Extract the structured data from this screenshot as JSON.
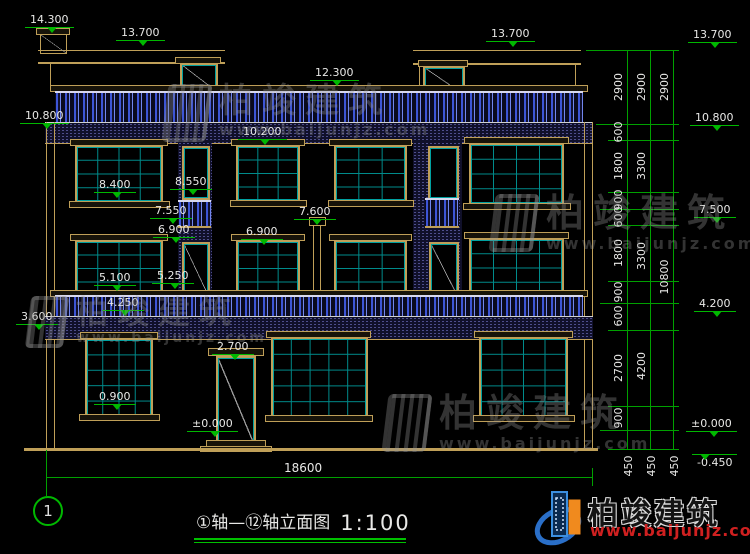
{
  "watermark": {
    "cn": "柏竣建筑",
    "url": "www.baijunjz.com"
  },
  "brand": {
    "cn": "柏竣建筑",
    "url": "www.baijunjz.com"
  },
  "title": {
    "text": "①轴—⑫轴立面图",
    "scale": "1:100"
  },
  "axis": {
    "left_bubble": "1"
  },
  "marks": {
    "e14300": "14.300",
    "e13700l": "13.700",
    "e12300": "12.300",
    "e13700c": "13.700",
    "e10800l": "10.800",
    "e10200": "10.200",
    "e8400": "8.400",
    "e8550": "8.550",
    "e7550": "7.550",
    "e6900l": "6.900",
    "e7600": "7.600",
    "e6900c": "6.900",
    "e5100": "5.100",
    "e5250": "5.250",
    "e4250": "4.250",
    "e3600": "3.600",
    "e2700": "2.700",
    "e0900": "0.900",
    "e0000door": "±0.000",
    "r13700": "13.700",
    "r10800": "10.800",
    "r7500": "7.500",
    "r4200": "4.200",
    "r0000": "±0.000",
    "rm0450": "-0.450"
  },
  "dims": {
    "total_width": "18600",
    "c1": [
      "2900",
      "600",
      "1800",
      "900",
      "600",
      "1800",
      "900",
      "600",
      "2700",
      "900"
    ],
    "c2": [
      "2900",
      "3300",
      "3300",
      "4200"
    ],
    "c3": [
      "2900",
      "10800"
    ],
    "base": [
      "450",
      "450",
      "450"
    ]
  }
}
